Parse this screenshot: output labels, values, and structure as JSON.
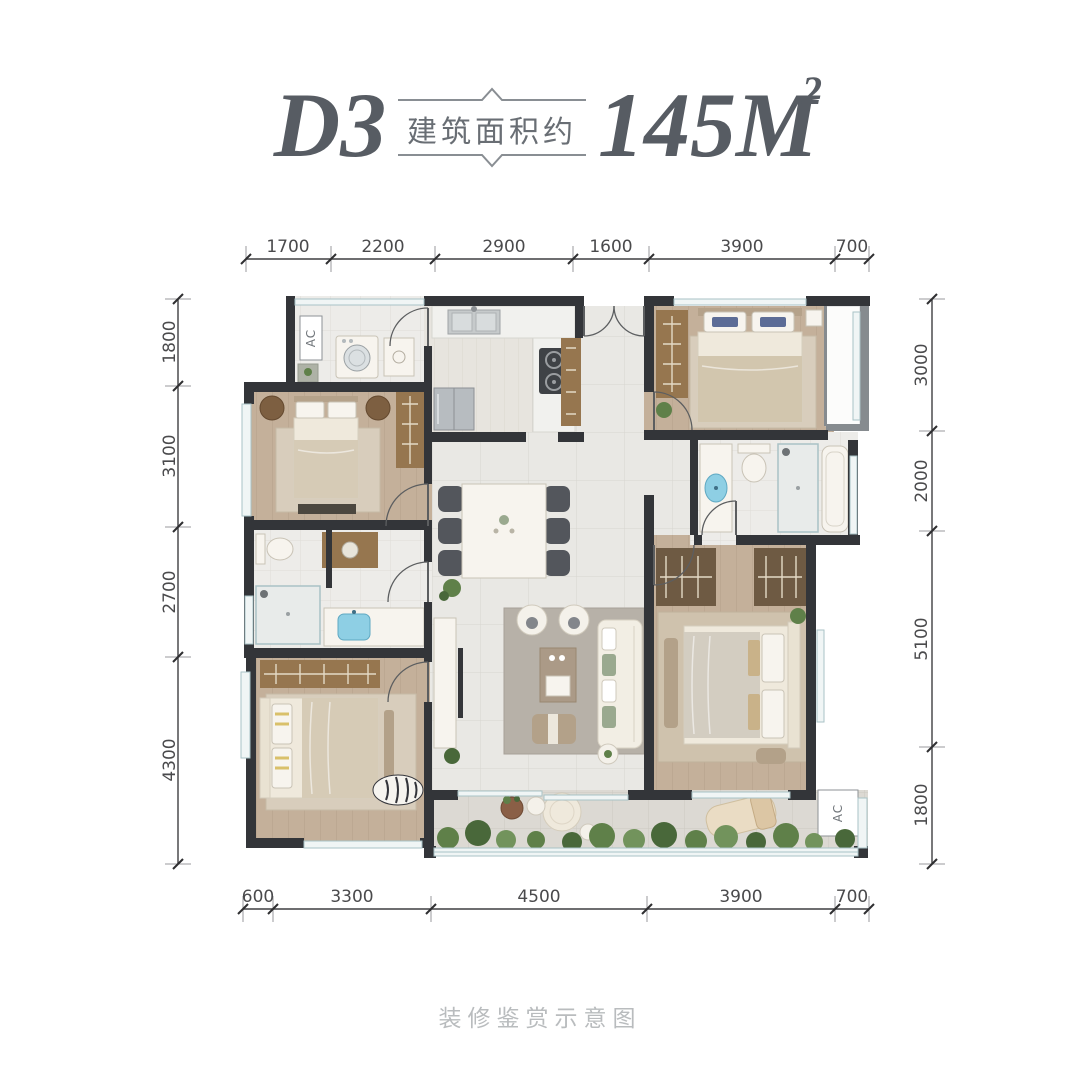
{
  "title": {
    "unit": "D3",
    "area_label": "建筑面积约",
    "area_value": "145M",
    "area_exponent": "2"
  },
  "caption": "装修鉴赏示意图",
  "dimensions": {
    "top": [
      "1700",
      "2200",
      "2900",
      "1600",
      "3900",
      "700"
    ],
    "bottom": [
      "600",
      "3300",
      "4500",
      "3900",
      "700"
    ],
    "left": [
      "1800",
      "3100",
      "2700",
      "4300"
    ],
    "right": [
      "3000",
      "2000",
      "5100",
      "1800"
    ]
  },
  "labels": {
    "ac_top_left": "AC",
    "ac_bottom_right": "AC"
  },
  "colors": {
    "title": "#575c63",
    "dimension_text": "#4a4a4c",
    "caption": "#b9bcbe",
    "wall": "#333539",
    "wood_floor": "#c4b09a",
    "tile_floor": "#e9e8e4",
    "accent_blue": "#8ecfe4",
    "plant_green": "#5f8049"
  }
}
